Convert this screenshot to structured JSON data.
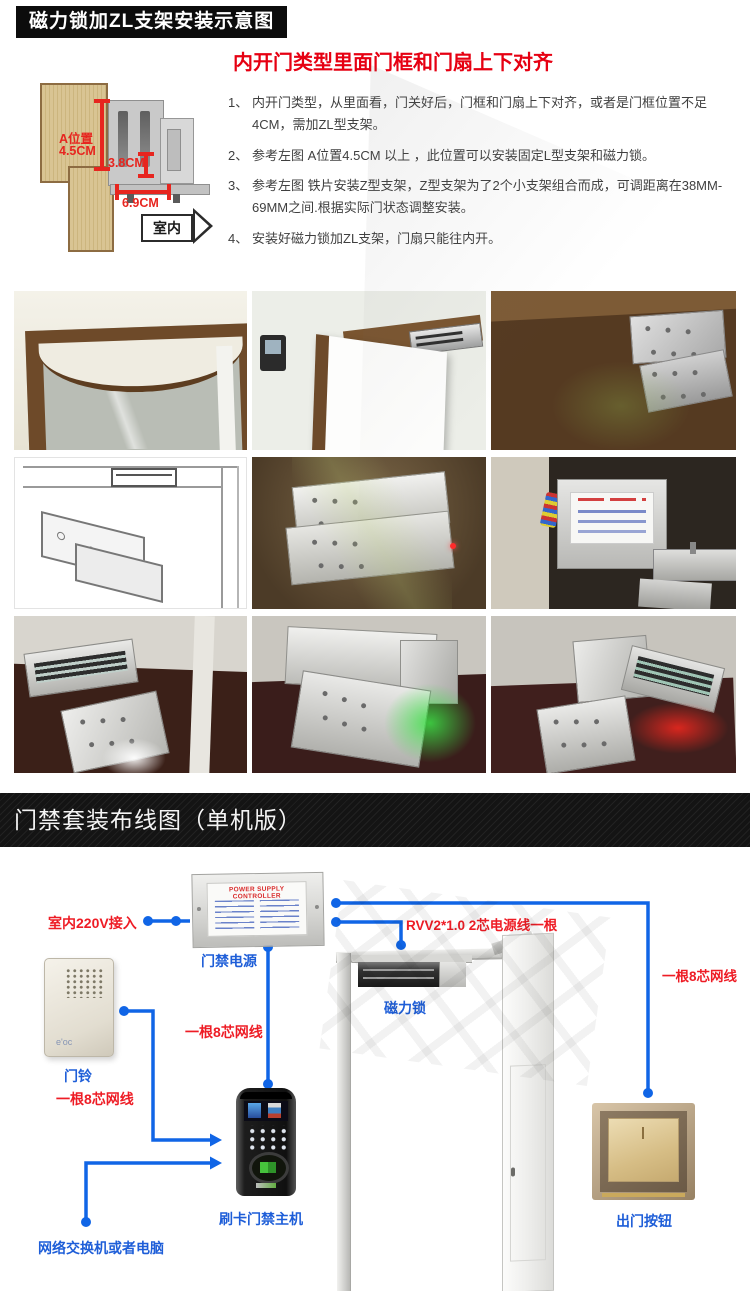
{
  "header": {
    "title": "磁力锁加ZL支架安装示意图"
  },
  "instructions": {
    "heading": "内开门类型里面门框和门扇上下对齐",
    "items": [
      {
        "num": "1、",
        "text": "内开门类型，从里面看，门关好后，门框和门扇上下对齐，或者是门框位置不足4CM，需加ZL型支架。"
      },
      {
        "num": "2、",
        "text": "参考左图 A位置4.5CM 以上 ，此位置可以安装固定L型支架和磁力锁。"
      },
      {
        "num": "3、",
        "text": "参考左图 铁片安装Z型支架，Z型支架为了2个小支架组合而成，可调距离在38MM-69MM之间.根据实际门状态调整安装。"
      },
      {
        "num": "4、",
        "text": "安装好磁力锁加ZL支架，门扇只能往内开。"
      }
    ]
  },
  "diagram": {
    "dim_a_label_1": "A位置",
    "dim_a_label_2": "4.5CM",
    "dim_b_label": "3.8CM",
    "dim_c_label": "6.9CM",
    "arrow_label": "室内"
  },
  "banner": {
    "title": "门禁套装布线图（单机版）"
  },
  "wiring": {
    "psu_panel_title": "POWER SUPPLY CONTROLLER",
    "mains_label": "室内220V接入",
    "psu_label": "门禁电源",
    "doorbell_label": "门铃",
    "doorbell_brand": "e'oc",
    "cable8_mid_label": "一根8芯网线",
    "cable8_left_label": "一根8芯网线",
    "cable8_right_label": "一根8芯网线",
    "rvv_label": "RVV2*1.0 2芯电源线一根",
    "maglock_label": "磁力锁",
    "host_label": "刷卡门禁主机",
    "network_label": "网络交换机或者电脑",
    "exit_button_label": "出门按钮"
  },
  "colors": {
    "line_blue": "#1065e6",
    "label_blue": "#1e5ed8",
    "label_red": "#ee1c25",
    "heading_red": "#e60012",
    "banner_bg": "#141414"
  }
}
